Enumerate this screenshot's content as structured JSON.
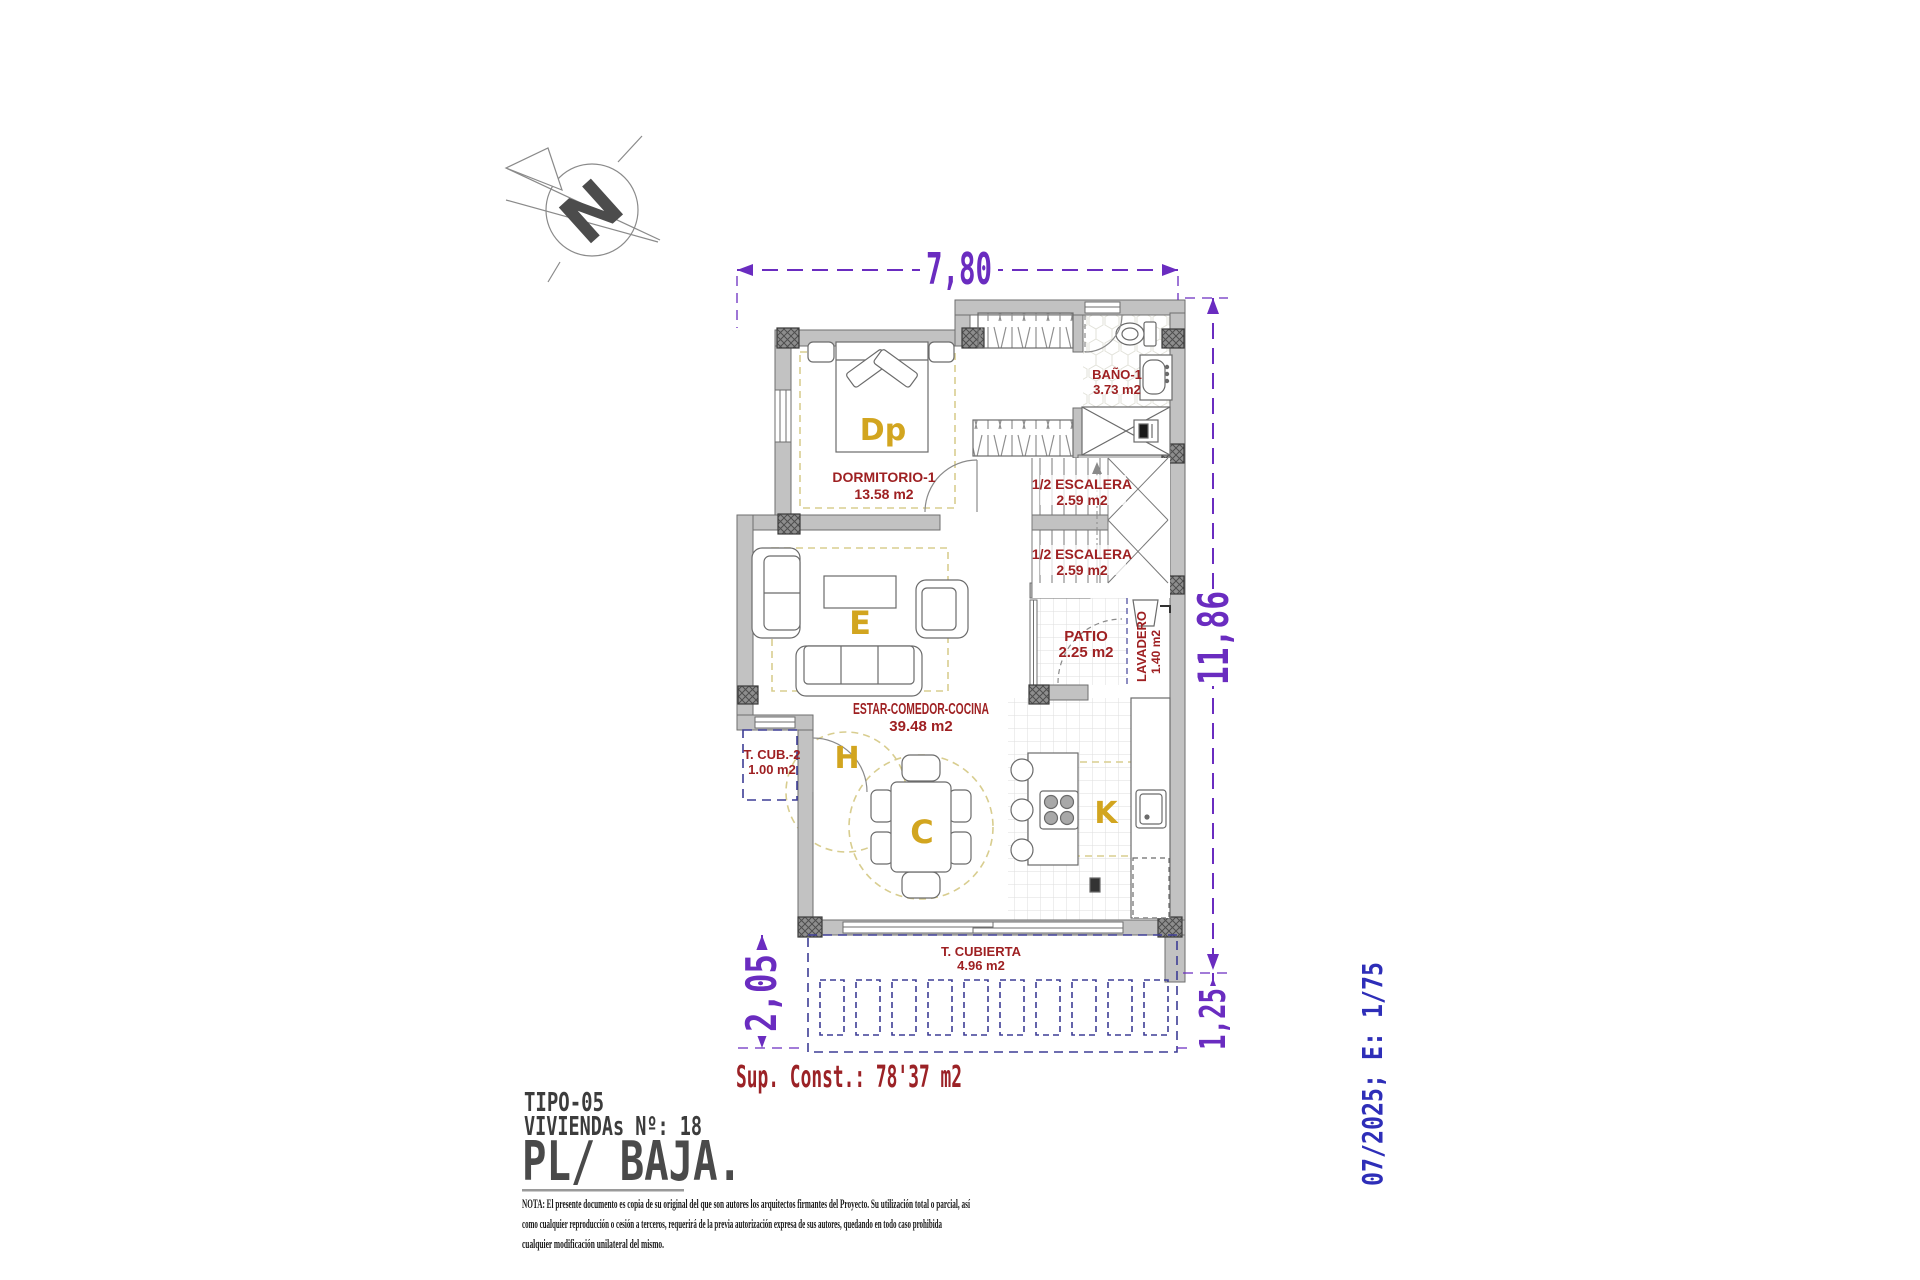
{
  "labels": {
    "north": "N"
  },
  "dimensions": {
    "top": "7,80",
    "right": "11,86",
    "left_bottom": "2,05",
    "right_bottom": "1,25"
  },
  "rooms": {
    "dormitorio1": {
      "name": "DORMITORIO-1",
      "area": "13.58 m2"
    },
    "bano1": {
      "name": "BAÑO-1",
      "area": "3.73 m2"
    },
    "escalera_a": {
      "name": "1/2 ESCALERA",
      "area": "2.59 m2"
    },
    "escalera_b": {
      "name": "1/2 ESCALERA",
      "area": "2.59 m2"
    },
    "patio": {
      "name": "PATIO",
      "area": "2.25 m2"
    },
    "lavadero": {
      "name": "LAVADERO",
      "area": "1.40 m2"
    },
    "estar_comedor_cocina": {
      "name": "ESTAR-COMEDOR-COCINA",
      "area": "39.48 m2"
    },
    "t_cub_2": {
      "name": "T. CUB.-2",
      "area": "1.00 m2"
    },
    "t_cubierta": {
      "name": "T. CUBIERTA",
      "area": "4.96 m2"
    }
  },
  "zone_letters": {
    "dormitorio": "Dp",
    "estar": "E",
    "comedor": "C",
    "cocina": "K",
    "hall": "H"
  },
  "summary": {
    "sup_const": "Sup. Const.: 78'37 m2"
  },
  "title_block": {
    "tipo": "TIPO-05",
    "viviendas": "VIVIENDAs Nº: 18",
    "planta": "PL/ BAJA."
  },
  "side_text": {
    "date_scale": "07/2025; E: 1/75"
  },
  "footer_note": {
    "line1": "NOTA: El presente documento es copia de su original del que son autores los arquitectos firmantes del Proyecto. Su utilización total o parcial, así",
    "line2": "como cualquier reproducción o cesión a terceros, requerirá  de la previa autorización expresa de sus autores, quedando en todo caso prohibida",
    "line3": "cualquier modificación unilateral del mismo."
  },
  "colors": {
    "dimension_purple": "#6a2cc0",
    "label_red": "#9e2022",
    "zone_gold": "#d2a51f",
    "date_blue": "#2e2eb8",
    "pergola_navy": "#3d3d95",
    "wall_gray": "#c2c2c2"
  }
}
